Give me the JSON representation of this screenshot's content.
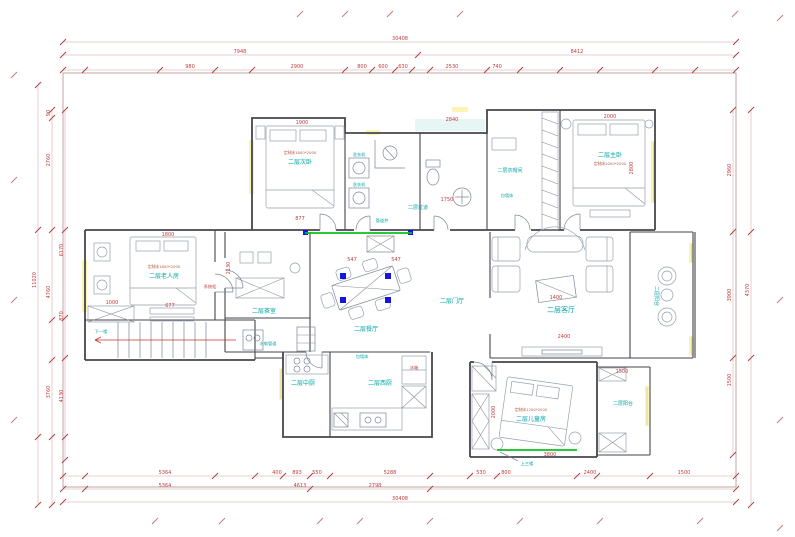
{
  "rooms": {
    "secondary_bedroom": "二层次卧",
    "closet": "二层衣帽间",
    "master_bedroom": "二层主卧",
    "elder_room": "二层老人房",
    "tea_room": "二层茶室",
    "dining_room": "二层餐厅",
    "foyer": "二层门厅",
    "living_room": "二层客厅",
    "balcony_east": "二层阳台",
    "corridor": "二层过道",
    "chinese_kitchen": "二层中厨",
    "western_kitchen": "二层西厨",
    "kids_room": "二层儿童房",
    "balcony_south": "二层阳台"
  },
  "annotations": {
    "pipe_shaft": "管道井",
    "wall_wrap": "包墙体",
    "wall_wrap2": "包墙体",
    "plumbing": "水电管道",
    "washer": "洗衣机",
    "washer2": "洗衣机",
    "fridge": "冰箱",
    "system_cabinet": "系统柜",
    "stair_down": "下一楼",
    "stair_up": "上三楼",
    "bed_spec_secondary": "定制床1800*2000",
    "bed_spec_master": "定制床2000*2000",
    "bed_spec_elder": "定制床1800*2000",
    "bed_spec_kids": "定制床1200*2000"
  },
  "dims": {
    "top": [
      "30408",
      "7948",
      "8412",
      "980",
      "2900",
      "800",
      "600",
      "630",
      "2530",
      "740"
    ],
    "bottom": [
      "5364",
      "400",
      "893",
      "550",
      "5288",
      "530",
      "800",
      "2400",
      "1500",
      "5364",
      "4613",
      "2798",
      "30408"
    ],
    "left": [
      "90",
      "2760",
      "4760",
      "3760",
      "11020",
      "6170",
      "870",
      "4130"
    ],
    "right": [
      "2960",
      "3900",
      "1500",
      "4370"
    ],
    "inner": [
      "1900",
      "2840",
      "2000",
      "2800",
      "1800",
      "1000",
      "677",
      "1750",
      "877",
      "547",
      "547",
      "2400",
      "2000",
      "3800",
      "1500",
      "2130",
      "1400"
    ]
  },
  "colors": {
    "room_label": "#00a5a5",
    "dimension_text": "#c23b3b",
    "accent_green": "#0cc01c",
    "accent_blue": "#1515dd",
    "window_yellow": "#fbf5b5"
  }
}
